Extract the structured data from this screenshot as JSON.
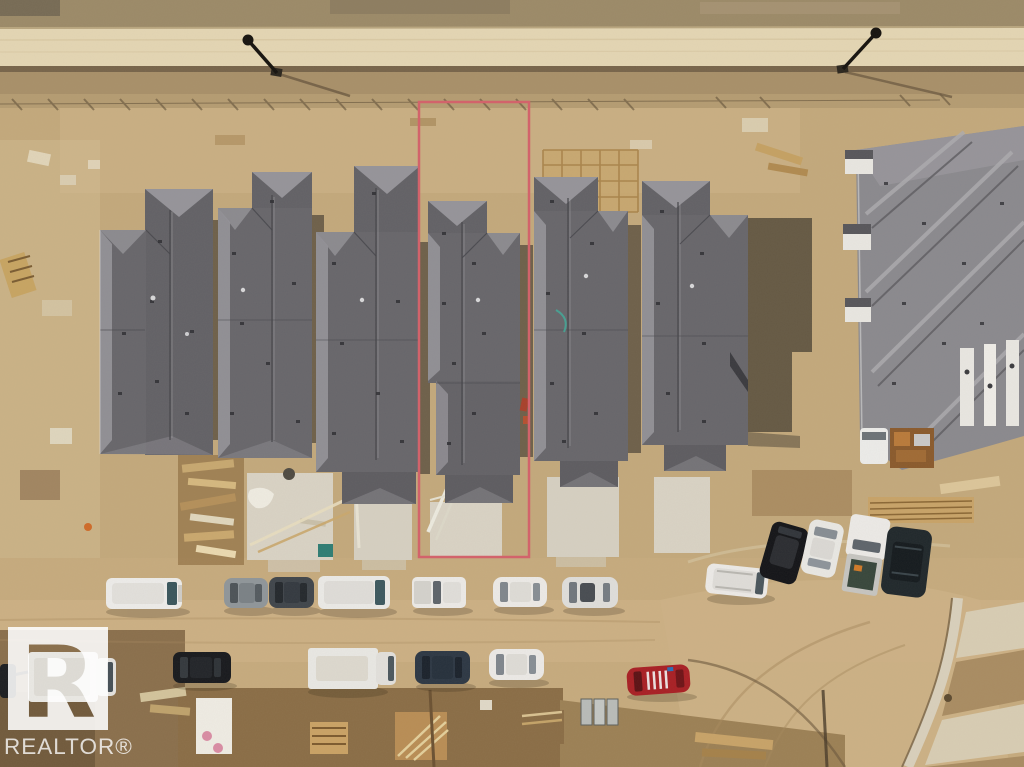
{
  "meta": {
    "description": "Aerial drone photograph of a townhouse construction site; six rows of grey-shingled townhomes, dirt roads with parked vehicles, and one lot outlined in red as the featured property.",
    "width": 1024,
    "height": 767
  },
  "watermark": {
    "brand": "REALTOR®",
    "logo_letter": "R",
    "color": "#ffffff"
  },
  "highlight": {
    "label": "featured-lot-outline",
    "color": "#d2636b"
  },
  "scene": {
    "ground_color": "#c3a97c",
    "graded_road_color": "#e4d6b4",
    "roof_dark": "#626166",
    "roof_light": "#95949a",
    "concrete_color": "#d9d3c5",
    "shadow_color": "#4a4234",
    "building_rows": 6,
    "large_building_complexes": 1,
    "vehicle_count": 19,
    "street_lights": 2
  }
}
